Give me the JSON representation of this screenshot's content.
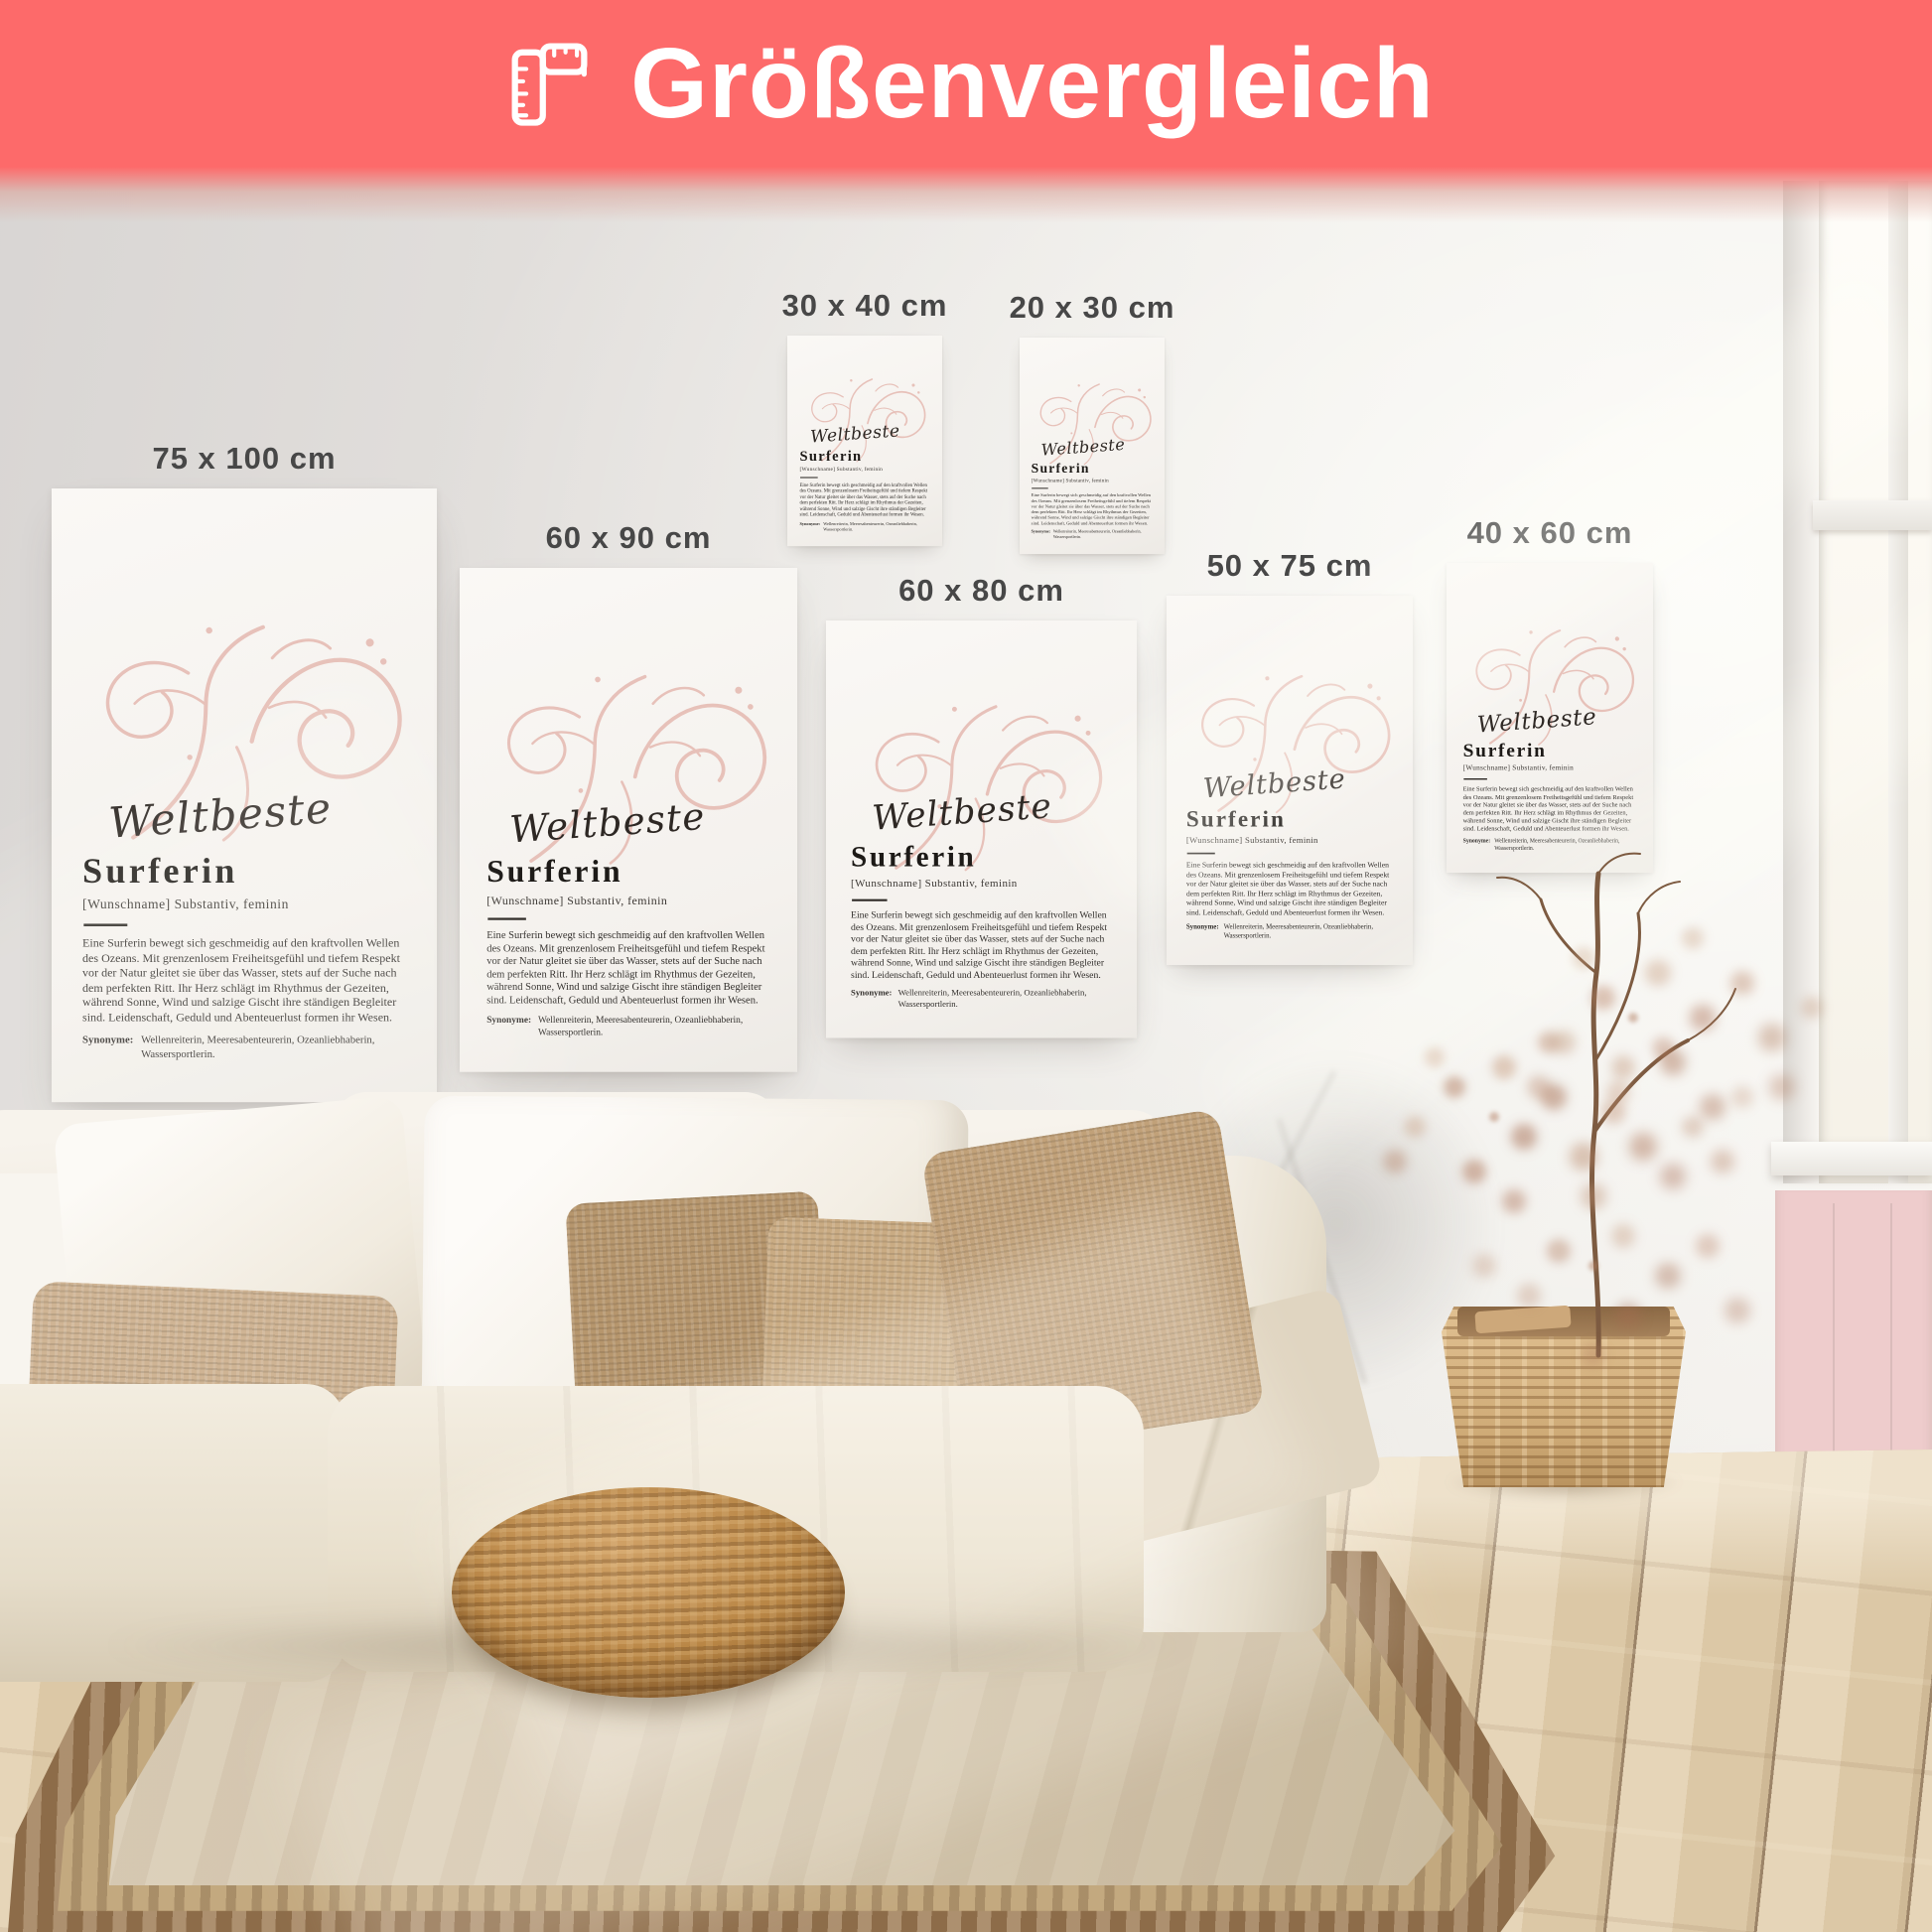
{
  "banner": {
    "title": "Größenvergleich",
    "icon": "ruler-icon",
    "bg_color": "#fd6a6a",
    "text_color": "#ffffff"
  },
  "posters": [
    {
      "label": "75 x 100 cm"
    },
    {
      "label": "60 x 90 cm"
    },
    {
      "label": "30 x 40 cm"
    },
    {
      "label": "20 x 30 cm"
    },
    {
      "label": "60 x 80 cm"
    },
    {
      "label": "50 x 75 cm"
    },
    {
      "label": "40 x 60 cm"
    }
  ],
  "poster_content": {
    "script_title": "Weltbeste",
    "title": "Surferin",
    "subtitle": "[Wunschname] Substantiv, feminin",
    "body": "Eine Surferin bewegt sich geschmeidig auf den kraftvollen Wellen des Ozeans. Mit grenzenlosem Freiheitsgefühl und tiefem Respekt vor der Natur gleitet sie über das Wasser, stets auf der Suche nach dem perfekten Ritt. Ihr Herz schlägt im Rhythmus der Gezeiten, während Sonne, Wind und salzige Gischt ihre ständigen Begleiter sind. Leidenschaft, Geduld und Abenteuerlust formen ihr Wesen.",
    "synonyms_label": "Synonyme:",
    "synonyms": "Wellenreiterin, Meeresabenteurerin, Ozeanliebhaberin, Wassersportlerin."
  },
  "colors": {
    "accent": "#fd6a6a",
    "size_label_text": "#474747",
    "ornament_pink": "#e6bcb4",
    "poster_background": "#f8f6f2"
  }
}
